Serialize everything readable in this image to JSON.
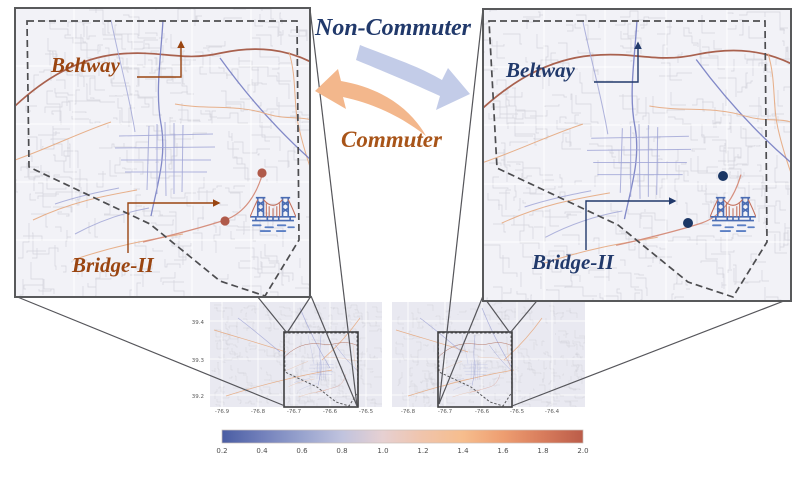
{
  "figure": {
    "top_flow_label": "Non-Commuter",
    "bottom_flow_label": "Commuter",
    "flows": [
      {
        "label": "Non-Commuter",
        "points_to": "right-map",
        "arrow_color": "#c3cce8"
      },
      {
        "label": "Commuter",
        "points_to": "left-map",
        "arrow_color": "#f3b78c"
      }
    ]
  },
  "left_panel": {
    "theme": "commuter",
    "beltway_label": "Beltway",
    "bridge_label": "Bridge-II",
    "label_color": "#9a4511",
    "marker_dot_color": "#b05a4a",
    "icon": "suspension-bridge-icon"
  },
  "right_panel": {
    "theme": "non-commuter",
    "beltway_label": "Beltway",
    "bridge_label": "Bridge-II",
    "label_color": "#21396b",
    "marker_dot_color": "#1b3765",
    "icon": "suspension-bridge-icon"
  },
  "small_maps": {
    "left": {
      "x_ticks": [
        "-76.9",
        "-76.8",
        "-76.7",
        "-76.6",
        "-76.5"
      ],
      "y_ticks": [
        "39.4",
        "39.3",
        "39.2"
      ]
    },
    "right": {
      "x_ticks": [
        "-76.8",
        "-76.7",
        "-76.6",
        "-76.5",
        "-76.4"
      ]
    }
  },
  "colorbar": {
    "min": 0.2,
    "max": 2.0,
    "ticks": [
      "0.2",
      "0.4",
      "0.6",
      "0.8",
      "1.0",
      "1.2",
      "1.4",
      "1.6",
      "1.8",
      "2.0"
    ],
    "gradient_stops": [
      "#4a5da3",
      "#7280bb",
      "#98a3ce",
      "#c0c3de",
      "#e6d0d2",
      "#f0c4ab",
      "#f6bd8d",
      "#ee9e71",
      "#d87c5c",
      "#bb5c49"
    ]
  },
  "colors": {
    "navy": "#21396b",
    "brown": "#9a4511",
    "commuter_orange": "#a85418",
    "beltway_road": "#a9614e",
    "arrow_blue": "#c3cce8",
    "arrow_orange": "#f3b78c",
    "dot_left": "#b05a4a",
    "dot_right": "#1b3765",
    "panel_bg": "#f2f2f7",
    "small_map_bg": "#e9e9f1",
    "panel_border": "#58595b"
  }
}
